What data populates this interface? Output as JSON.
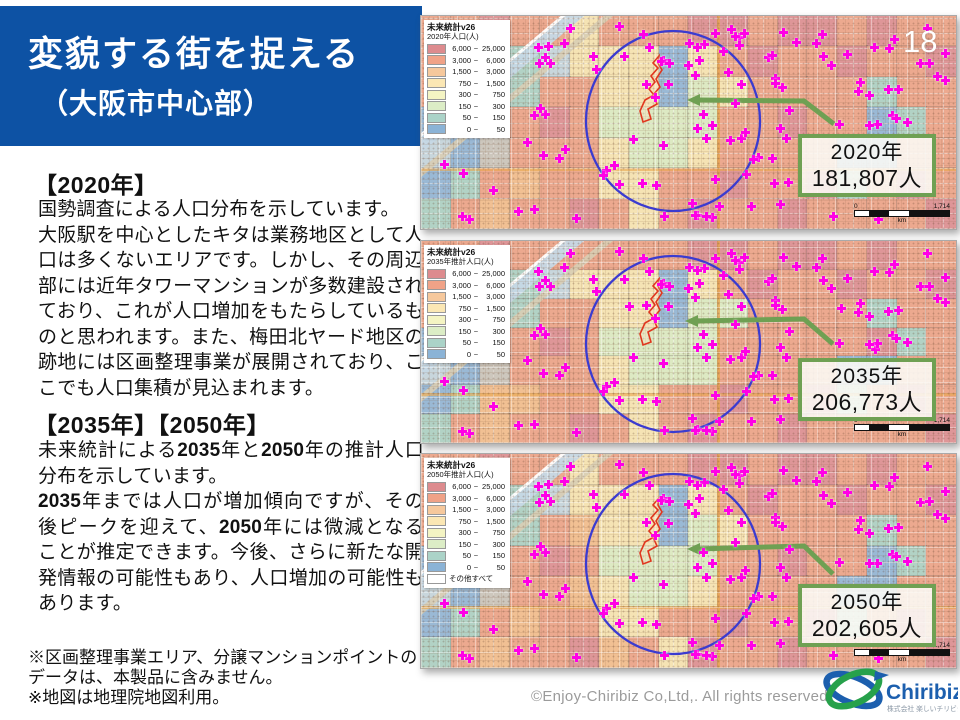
{
  "slide": {
    "page_number": "18",
    "title_line1": "変貌する街を捉える",
    "title_line2": "（大阪市中心部）",
    "footer": "©Enjoy-Chiribiz Co,Ltd,. All rights reserved."
  },
  "left_panel": {
    "sections": [
      {
        "heading": "【2020年】",
        "body": "国勢調査による人口分布を示しています。\n大阪駅を中心としたキタは業務地区として人口は多くないエリアです。しかし、その周辺部には近年タワーマンションが多数建設されており、これが人口増加をもたらしているものと思われます。また、梅田北ヤード地区の跡地には区画整理事業が展開されており、ここでも人口集積が見込まれます。"
      },
      {
        "heading": "【2035年】【2050年】",
        "body": "未来統計による**2035**年と**2050**年の推計人口分布を示しています。\n**2035**年までは人口が増加傾向ですが、その後ピークを迎えて、**2050**年には微減となることが推定できます。今後、さらに新たな開発情報の可能性もあり、人口増加の可能性もあります。"
      }
    ],
    "notes": "※区画整理事業エリア、分譲マンションポイントの\nデータは、本製品に含みません。\n※地図は地理院地図利用。"
  },
  "legend": {
    "sep": "~",
    "rows": [
      {
        "from": "6,000",
        "to": "25,000",
        "color": "#dd8b8e"
      },
      {
        "from": "3,000",
        "to": "6,000",
        "color": "#f0a287"
      },
      {
        "from": "1,500",
        "to": "3,000",
        "color": "#f6c89c"
      },
      {
        "from": "750",
        "to": "1,500",
        "color": "#fbe7b4"
      },
      {
        "from": "300",
        "to": "750",
        "color": "#f4f4c3"
      },
      {
        "from": "150",
        "to": "300",
        "color": "#dcedc6"
      },
      {
        "from": "50",
        "to": "150",
        "color": "#abd3c8"
      },
      {
        "from": "0",
        "to": "50",
        "color": "#8bb3d6"
      }
    ]
  },
  "maps": [
    {
      "legend_title": "未来統計v26",
      "legend_subtitle": "2020年人口(人)",
      "legend_extra_row": "",
      "callout": {
        "year": "2020年",
        "population": "181,807人"
      },
      "marker_seed": 7,
      "grid": [
        "sspsscsssppsppspss",
        "ssstwcccbcspsspssp",
        "spwtssccbgcsssstss",
        "bwtspsggggsspssbts",
        "wbassscggcssssbbss",
        "btsossccsspssptsps",
        "tsosspscspsspssssp"
      ]
    },
    {
      "legend_title": "未来統計v26",
      "legend_subtitle": "2035年推計人口(人)",
      "legend_extra_row": "",
      "callout": {
        "year": "2035年",
        "population": "206,773人"
      },
      "marker_seed": 7,
      "grid": [
        "sspssssssppsppspss",
        "ssstwcccbcspsspssp",
        "spwtssccbggsssstss",
        "bwtspsggggssssspts",
        "wbassscgggssssbbss",
        "btoossccsspssptsps",
        "tsosspscspsspssssp"
      ]
    },
    {
      "legend_title": "未来統計v26",
      "legend_subtitle": "2050年推計人口(人)",
      "legend_extra_row": "その他すべて",
      "callout": {
        "year": "2050年",
        "population": "202,605人"
      },
      "marker_seed": 7,
      "grid": [
        "sspsscsssppsppspss",
        "ssstwcccbcspsspssp",
        "spwtsoccbgcsssstss",
        "bwtspsggggsspssbts",
        "wbassocggcssssbbss",
        "btsossccsspssptsps",
        "tsossposcpsspssssp"
      ]
    }
  ],
  "scalebar": {
    "left_label": "0",
    "right_label": "1,714",
    "unit_label": "km"
  },
  "logo": {
    "text": "Chiribiz",
    "subtext": "株式会社 楽しいチリビジ"
  },
  "colors": {
    "banner_blue": "#0d52a4",
    "callout_green": "#6fa053",
    "circle_blue": "#3b3bd0",
    "marker_magenta": "#ff00e6",
    "red_area": "#e0371f",
    "palette": {
      "s": "#eda287",
      "p": "#dd8b92",
      "o": "#f3bd8c",
      "c": "#f8e6b2",
      "y": "#f4f4c3",
      "g": "#dcedc4",
      "t": "#a9d2c6",
      "b": "#8db4d9",
      "a": "#c9c5bd",
      "w": "#c3d6e2"
    }
  }
}
